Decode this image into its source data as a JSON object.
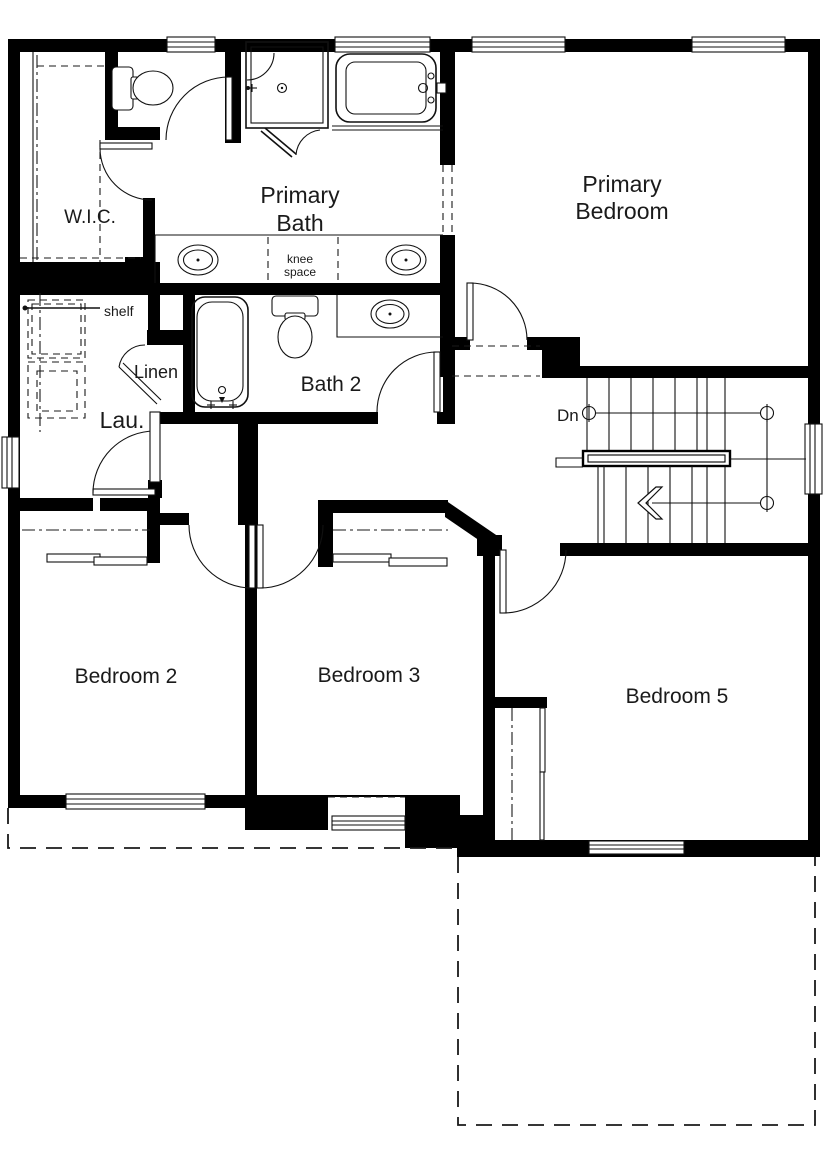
{
  "plan": {
    "labels": {
      "wic": "W.I.C.",
      "primary_bath": [
        "Primary",
        "Bath"
      ],
      "knee_space": [
        "knee",
        "space"
      ],
      "primary_bedroom": [
        "Primary",
        "Bedroom"
      ],
      "shelf": "shelf",
      "linen": "Linen",
      "laundry": "Lau.",
      "bath2": "Bath 2",
      "down": "Dn",
      "bedroom2": "Bedroom 2",
      "bedroom3": "Bedroom 3",
      "bedroom5": "Bedroom 5"
    },
    "colors": {
      "wall": "#000000",
      "line": "#1a1a1a",
      "background": "#ffffff",
      "text": "#1a1a1a"
    }
  }
}
